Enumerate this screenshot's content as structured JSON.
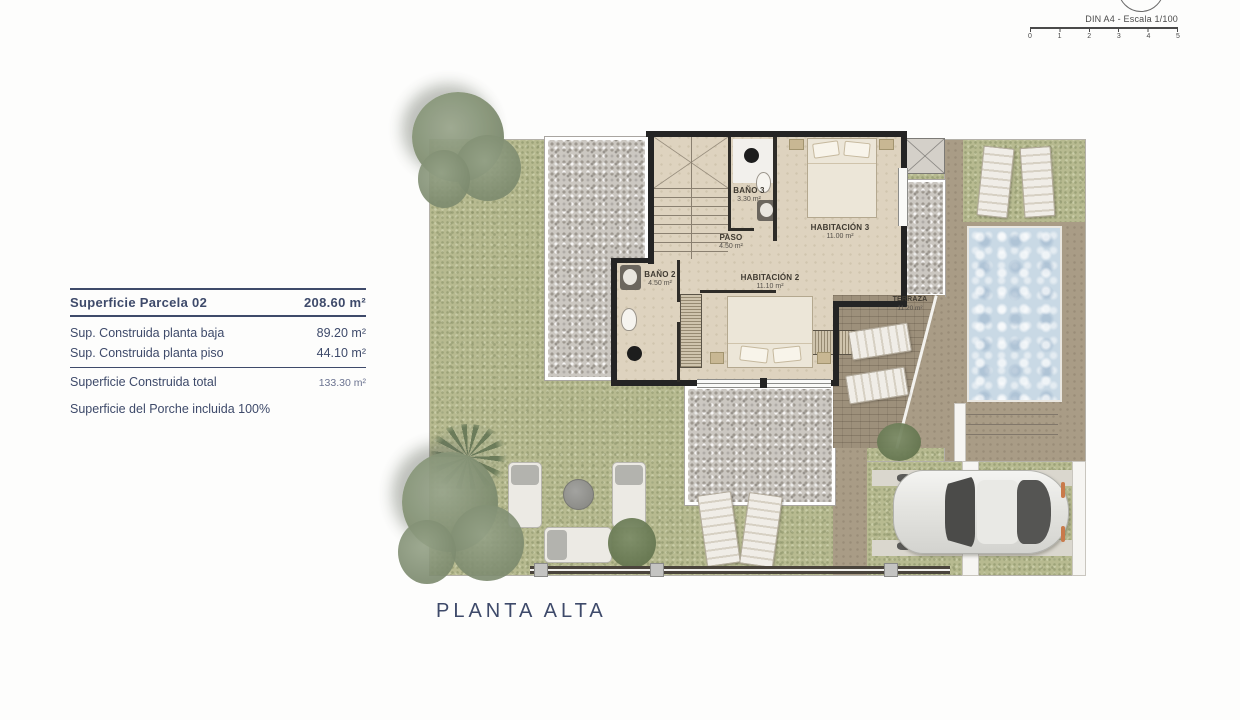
{
  "page": {
    "title": "PLANTA ALTA"
  },
  "legend": {
    "title": {
      "label": "Superficie Parcela 02",
      "value": "208.60 m²"
    },
    "rows": [
      {
        "label": "Sup. Construida planta baja",
        "value": "89.20 m²"
      },
      {
        "label": "Sup. Construida planta piso",
        "value": "44.10 m²"
      }
    ],
    "total": {
      "label": "Superficie Construida total",
      "value": "133.30 m²"
    },
    "note": "Superficie del Porche incluida 100%"
  },
  "scalebar": {
    "label": "DIN A4 - Escala 1/100",
    "ticks": [
      "0",
      "1",
      "2",
      "3",
      "4",
      "5"
    ]
  },
  "rooms": {
    "bano3": {
      "name": "BAÑO 3",
      "area": "3.30 m²"
    },
    "paso": {
      "name": "PASO",
      "area": "4.50 m²"
    },
    "hab3": {
      "name": "HABITACIÓN 3",
      "area": "11.00 m²"
    },
    "bano2": {
      "name": "BAÑO 2",
      "area": "4.50 m²"
    },
    "hab2": {
      "name": "HABITACIÓN 2",
      "area": "11.10 m²"
    },
    "terraza": {
      "name": "TERRAZA",
      "area": "11.20 m²"
    }
  },
  "colors": {
    "text_navy": "#3e4a6a",
    "wall": "#242424",
    "grass": "#b7ba90",
    "gravel": "#cbc7c1",
    "floor": "#ded3bf",
    "deck": "#a99c86",
    "terrace": "#9d907b",
    "water": "#c9d9e5"
  }
}
